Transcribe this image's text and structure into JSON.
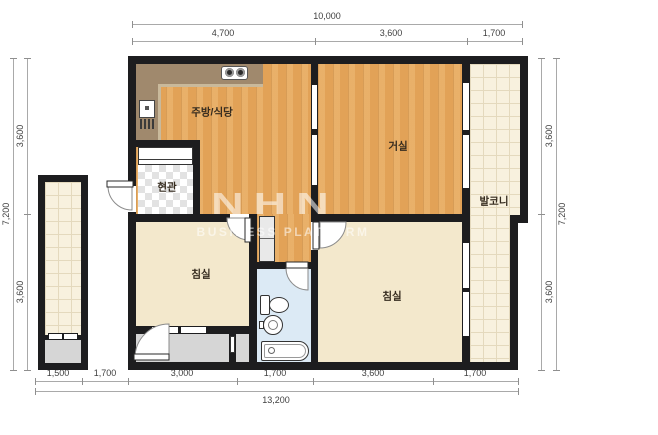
{
  "watermark": {
    "line1": "NHN",
    "line2": "BUSINESS PLATFORM"
  },
  "rooms": {
    "kitchen_dining": "주방/식당",
    "living_room": "거실",
    "entrance": "현관",
    "balcony": "발코니",
    "bedroom_left": "침실",
    "bedroom_right": "침실"
  },
  "dimensions": {
    "top": {
      "total": "10,000",
      "segments": [
        "4,700",
        "3,600",
        "1,700"
      ]
    },
    "bottom": {
      "total": "13,200",
      "segments": [
        "1,500",
        "1,700",
        "3,000",
        "1,700",
        "3,600",
        "1,700"
      ]
    },
    "left": {
      "total": "7,200",
      "segments": [
        "3,600",
        "3,600"
      ]
    },
    "right": {
      "total": "7,200",
      "segments": [
        "3,600",
        "3,600"
      ]
    }
  },
  "colors": {
    "wall": "#1d1d1f",
    "wood_floor": "#e2a257",
    "bedroom_floor": "#f3e8cc",
    "tile_floor": "#f8f1de",
    "bathroom_floor": "#dceaf5",
    "kitchen_counter": "#a0896d",
    "utility_gray": "#d6d6d6"
  }
}
